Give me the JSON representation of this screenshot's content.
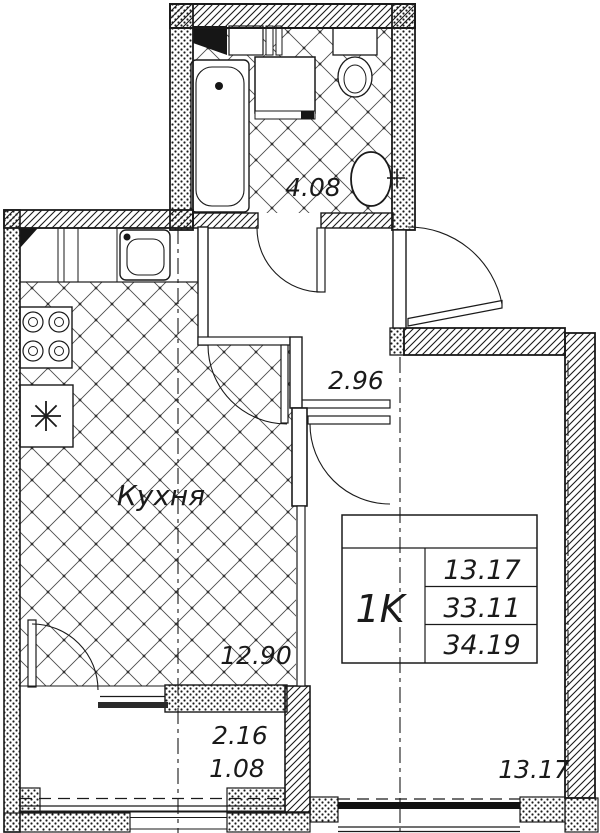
{
  "document": {
    "type": "apartment-floor-plan",
    "apartment_type": "1K"
  },
  "labels": {
    "bathroom_area": "4.08",
    "hallway_area": "2.96",
    "kitchen_name": "Кухня",
    "kitchen_area": "12.90",
    "balcony_area_full": "2.16",
    "balcony_area_reduced": "1.08",
    "room_area": "13.17"
  },
  "info_table": {
    "apartment_type": "1K",
    "rows": [
      "13.17",
      "33.11",
      "34.19"
    ]
  },
  "fixtures": [
    "bathtub",
    "washing-machine",
    "toilet",
    "wash-basin",
    "kitchen-counter",
    "kitchen-sink",
    "stove",
    "refrigerator"
  ],
  "colors": {
    "line": "#1a1a1a",
    "background": "#ffffff"
  }
}
